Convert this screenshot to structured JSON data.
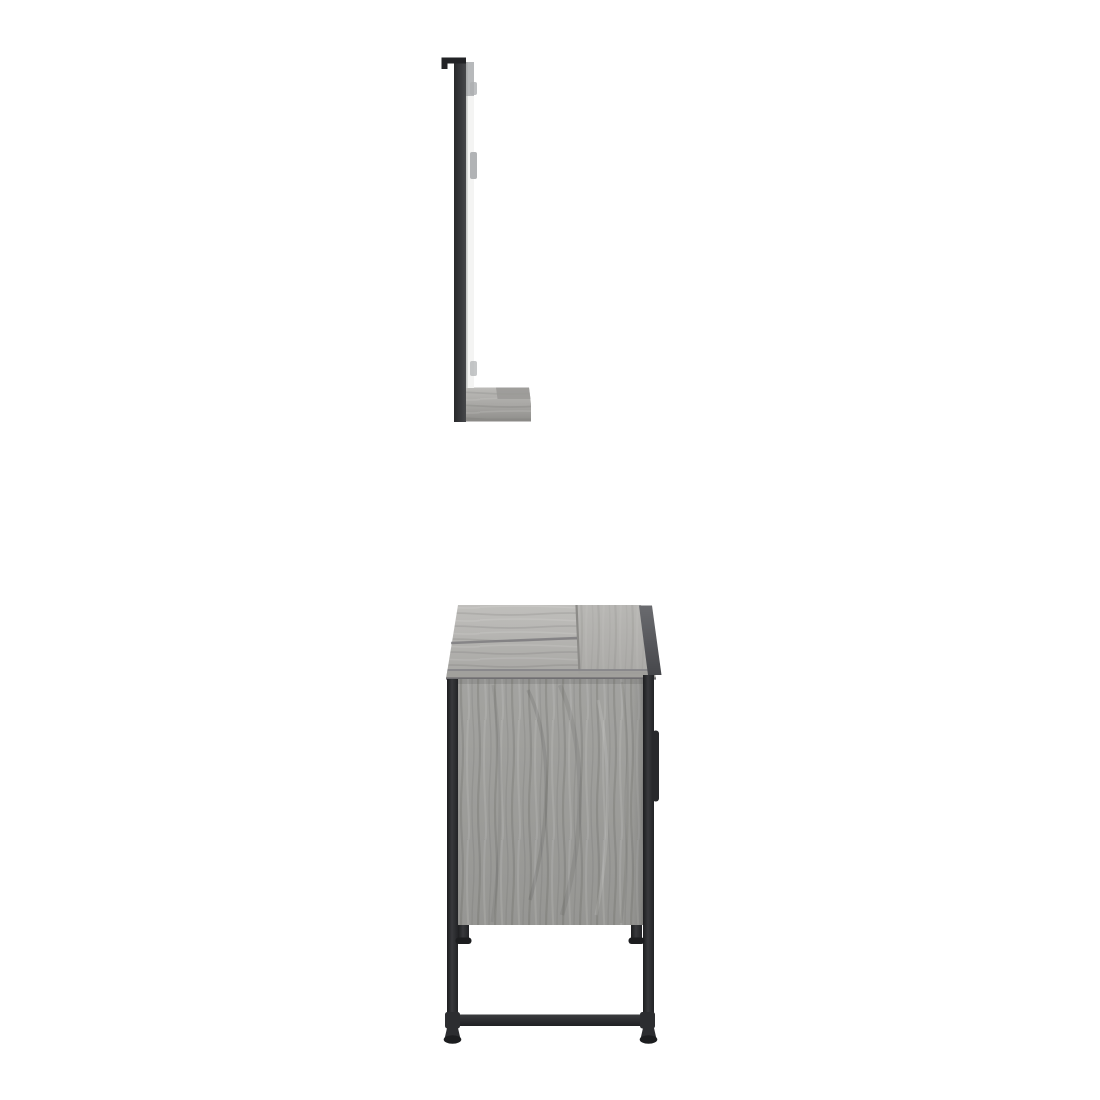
{
  "scene": {
    "description": "Side-view product photo of a grey sonoma oak bathroom furniture set: a wall-hung mirror with bottom shelf and hanging bracket above a freestanding sink cabinet with a black steel frame, on a plain white background",
    "background": "#ffffff"
  },
  "palette": {
    "metal_dark": "#222326",
    "metal_deep": "#1d1e20",
    "metal_mid": "#38393c",
    "metal_soft": "#2c2d30",
    "frame_left": "#28292b",
    "frame_right": "#46474a",
    "mirror_white": "#f4f4f3",
    "mirror_grey_top": "#b3b5b7",
    "clip_grey": "#adafb1",
    "wood_top_light": "#c0bfbc",
    "wood_top_shade": "#a7a6a3",
    "wood_lid_light": "#b8b7b4",
    "wood_lid_shade": "#abaaa7",
    "wood_side_light": "#a3a3a0",
    "wood_side_shade": "#969693",
    "wood_shelf_light": "#bcbbb8",
    "wood_shelf_shade": "#a9a8a5",
    "shelf_front_light": "#aaa9a6",
    "shelf_front_shade": "#8f8e8b",
    "shelf_lip": "#8b8a87",
    "shelf_shadow_patch": "#9a9996",
    "seam": "#77767a",
    "front_band": "#a09f9c",
    "band_top_line": "#868589",
    "band_bottom_line": "#6f6e71",
    "lid_edge_line": "#8c8b88",
    "grey_edge_top": "#6a6b6f",
    "grey_edge_bottom": "#46474b",
    "handle": "#28292c",
    "bar_top": "#3b3c3f",
    "bar_bottom": "#1f2023",
    "foot_cap": "#1c1d1f"
  },
  "product": {
    "items": [
      {
        "id": "wall-mirror-with-shelf",
        "parts": [
          "hanging-bracket",
          "frame-back",
          "mirror-edge",
          "mounting-clips",
          "wood-shelf"
        ]
      },
      {
        "id": "sink-cabinet",
        "parts": [
          "wood-top-panel",
          "raised-lid",
          "side-panel",
          "black-frame-posts",
          "door-handle",
          "adjustable-feet",
          "base-crossbar",
          "frame-feet"
        ]
      }
    ]
  }
}
